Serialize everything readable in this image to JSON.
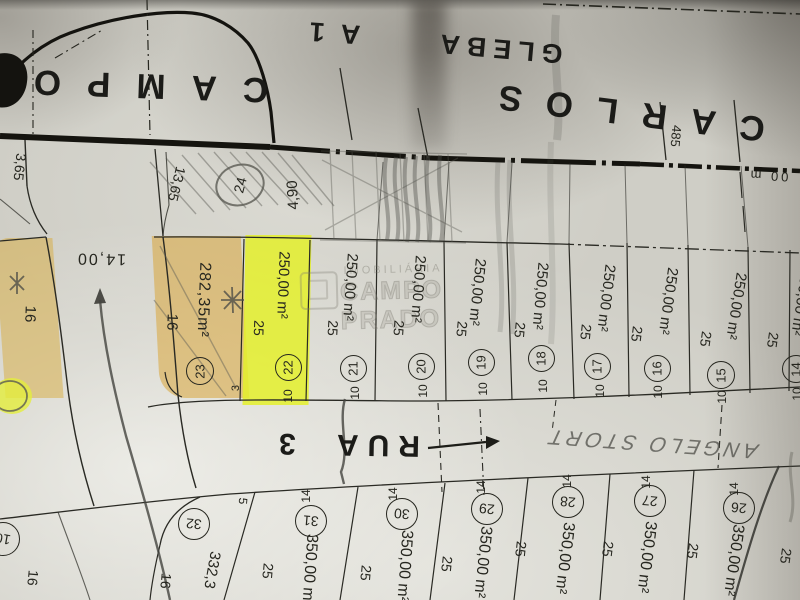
{
  "title_band": {
    "street_word_right": "CARLOS",
    "street_word_left": "CAMPO",
    "gleba_word": "GLEBA",
    "gleba_num": "A1",
    "dim_485": "485",
    "fragment_00m": "00 m"
  },
  "left_area": {
    "dim_13_65": "13,65",
    "dim_3_65": "3,65",
    "street_width": "14,00",
    "side_16": "16"
  },
  "lot_24": {
    "number": "24",
    "dim_4_90": "4,90"
  },
  "lot_23": {
    "number": "23",
    "area": "282,35m²",
    "side": "16",
    "front": "3"
  },
  "top_row": {
    "lots": [
      {
        "number": "22",
        "area": "250,00 m²",
        "side": "25",
        "front": "10"
      },
      {
        "number": "21",
        "area": "250,00 m²",
        "side": "25",
        "front": "10"
      },
      {
        "number": "20",
        "area": "250,00 m²",
        "side": "25",
        "front": "10"
      },
      {
        "number": "19",
        "area": "250,00 m²",
        "side": "25",
        "front": "10"
      },
      {
        "number": "18",
        "area": "250,00 m²",
        "side": "25",
        "front": "10"
      },
      {
        "number": "17",
        "area": "250,00 m²",
        "side": "25",
        "front": "10"
      },
      {
        "number": "16",
        "area": "250,00 m²",
        "side": "25",
        "front": "10"
      },
      {
        "number": "15",
        "area": "250,00 m²",
        "side": "25",
        "front": "10"
      },
      {
        "number": "14",
        "area": "250,00 m²",
        "side": "25",
        "front": "10"
      }
    ]
  },
  "rua3": {
    "name": "RUA 3"
  },
  "handwriting": {
    "text": "ANGELO STORT"
  },
  "lot_32": {
    "number": "32",
    "area": "332,3",
    "side_a": "16",
    "side_b": "16",
    "dim_5": "5"
  },
  "bottom_row": {
    "lots": [
      {
        "number": "31",
        "front": "14",
        "area": "350,00 m²"
      },
      {
        "number": "30",
        "front": "14",
        "area": "350,00 m²"
      },
      {
        "number": "29",
        "front": "14",
        "area": "350,00 m²"
      },
      {
        "number": "28",
        "front": "14",
        "area": "350,00 m²"
      },
      {
        "number": "27",
        "front": "14",
        "area": "350,00 m²"
      },
      {
        "number": "26",
        "front": "14",
        "area": "350,00 m²"
      }
    ],
    "gap_dims": [
      "25",
      "25",
      "25",
      "25",
      "25",
      "25",
      "25"
    ]
  },
  "corner_lot": {
    "number": "10"
  },
  "watermark": {
    "line1": "IMOBILIÁRIA",
    "line2": "CAMPO PRADO"
  }
}
